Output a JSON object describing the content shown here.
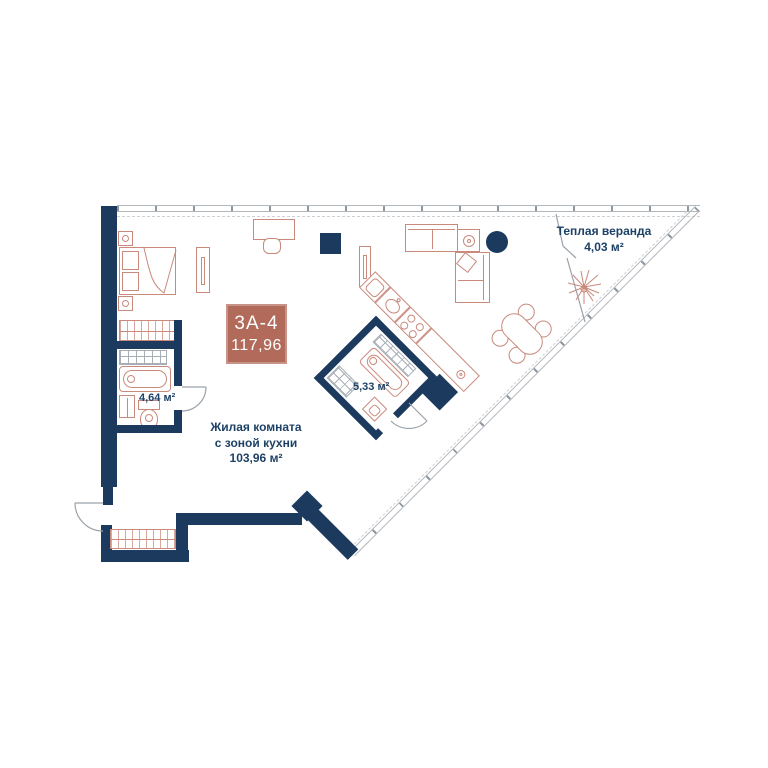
{
  "badge": {
    "unit": "3А-4",
    "total_area": "117,96"
  },
  "rooms": {
    "living": {
      "name_line1": "Жилая комната",
      "name_line2": "с зоной кухни",
      "area": "103,96 м²"
    },
    "bathroom": {
      "area": "4,64 м²"
    },
    "bathroom2": {
      "area": "5,33 м²"
    },
    "veranda": {
      "name": "Теплая веранда",
      "area": "4,03 м²"
    }
  },
  "icons": {
    "plant": "radiating-lines-plant",
    "column_round": "filled-circle",
    "column_square": "filled-square"
  },
  "colors": {
    "wall": "#1b3a5e",
    "furniture_line": "#c9897b",
    "badge_bg": "#b26a5a",
    "label_text": "#1d4166",
    "glass_line": "#b3b8bd"
  }
}
